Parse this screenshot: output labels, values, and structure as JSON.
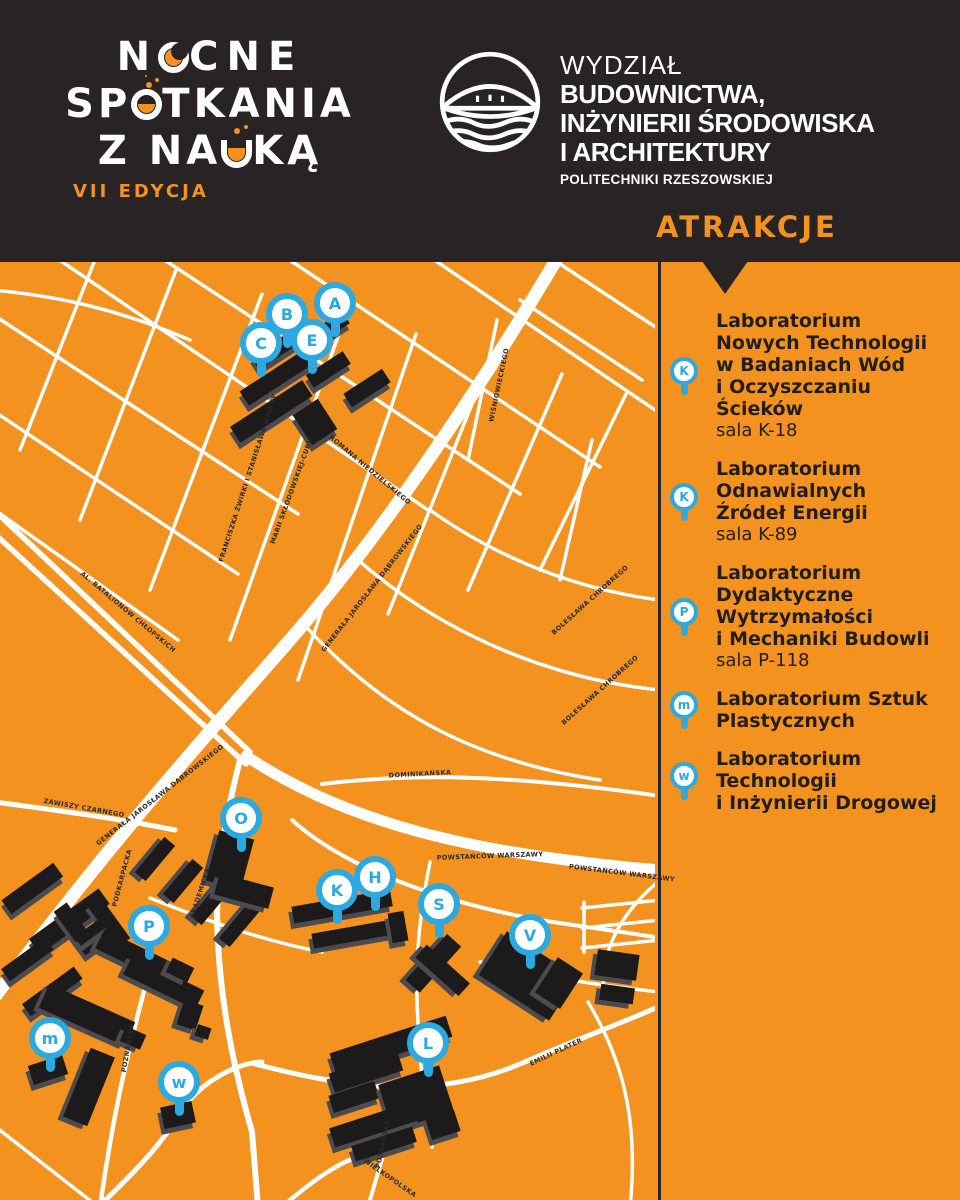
{
  "colors": {
    "orange": "#F3921E",
    "dark": "#282325",
    "pin_blue": "#2BA9E0",
    "building": "#1D1A1B",
    "road": "#FFFFFF"
  },
  "logo": {
    "word1_start": "N",
    "word1_end": "CNE",
    "word2_start": "SP",
    "word2_end": "TKANIA",
    "word3_start": "Z NA",
    "word3_end": "KĄ",
    "edition": "VII EDYCJA"
  },
  "faculty": {
    "line1": "WYDZIAŁ",
    "line2": "BUDOWNICTWA,",
    "line3": "INŻYNIERII ŚRODOWISKA",
    "line4": "I ARCHITEKTURY",
    "line5": "POLITECHNIKI RZESZOWSKIEJ"
  },
  "attractions": {
    "title": "ATRAKCJE",
    "items": [
      {
        "pin": "K",
        "title": "Laboratorium\nNowych Technologii\nw Badaniach Wód\ni Oczyszczaniu\nŚcieków",
        "room": "sala K-18"
      },
      {
        "pin": "K",
        "title": "Laboratorium\nOdnawialnych\nŹródeł Energii",
        "room": "sala K-89"
      },
      {
        "pin": "P",
        "title": "Laboratorium\nDydaktyczne\nWytrzymałości\ni Mechaniki Budowli",
        "room": "sala P-118"
      },
      {
        "pin": "m",
        "title": "Laboratorium Sztuk\nPlastycznych",
        "room": ""
      },
      {
        "pin": "w",
        "title": "Laboratorium\nTechnologii\ni Inżynierii Drogowej",
        "room": ""
      }
    ]
  },
  "map": {
    "pins": [
      {
        "letter": "A",
        "x": 335,
        "y": 303
      },
      {
        "letter": "B",
        "x": 287,
        "y": 314
      },
      {
        "letter": "C",
        "x": 261,
        "y": 343
      },
      {
        "letter": "E",
        "x": 312,
        "y": 340
      },
      {
        "letter": "O",
        "x": 241,
        "y": 818
      },
      {
        "letter": "P",
        "x": 149,
        "y": 926
      },
      {
        "letter": "K",
        "x": 337,
        "y": 890
      },
      {
        "letter": "H",
        "x": 375,
        "y": 877
      },
      {
        "letter": "S",
        "x": 439,
        "y": 904
      },
      {
        "letter": "V",
        "x": 530,
        "y": 935
      },
      {
        "letter": "m",
        "x": 50,
        "y": 1038
      },
      {
        "letter": "w",
        "x": 179,
        "y": 1082
      },
      {
        "letter": "L",
        "x": 428,
        "y": 1043
      }
    ],
    "street_labels": [
      {
        "text": "FRANCISZKA ŻWIRKI I STANISŁAWA WIGURY",
        "x": 248,
        "y": 478,
        "angle": -72
      },
      {
        "text": "MARII SKŁODOWSKIEJ-CURIE",
        "x": 292,
        "y": 490,
        "angle": -70
      },
      {
        "text": "ROMANA NIEDZIELSKIEGO",
        "x": 370,
        "y": 470,
        "angle": 40
      },
      {
        "text": "WIŚNIOWIECKIEGO",
        "x": 499,
        "y": 385,
        "angle": -78
      },
      {
        "text": "BOLESŁAWA CHROBREGO",
        "x": 590,
        "y": 600,
        "angle": -42
      },
      {
        "text": "BOLESŁAWA CHROBREGO",
        "x": 600,
        "y": 690,
        "angle": -42
      },
      {
        "text": "AL. BATALIONÓW CHŁOPSKICH",
        "x": 128,
        "y": 612,
        "angle": 40
      },
      {
        "text": "GENERAŁA JAROSŁAWA DĄBROWSKIEGO",
        "x": 372,
        "y": 588,
        "angle": -52
      },
      {
        "text": "GENERAŁA JAROSŁAWA DĄBROWSKIEGO",
        "x": 160,
        "y": 795,
        "angle": -38
      },
      {
        "text": "ZAWISZY CZARNEGO",
        "x": 84,
        "y": 808,
        "angle": 10
      },
      {
        "text": "PODKARPACKA",
        "x": 122,
        "y": 878,
        "angle": -75
      },
      {
        "text": "AKADEMICKA",
        "x": 200,
        "y": 893,
        "angle": -72
      },
      {
        "text": "POWSTAŃCÓW WARSZAWY",
        "x": 490,
        "y": 856,
        "angle": -2
      },
      {
        "text": "POWSTAŃCÓW WARSZAWY",
        "x": 622,
        "y": 873,
        "angle": 7
      },
      {
        "text": "DOMINIKAŃSKA",
        "x": 420,
        "y": 774,
        "angle": -3
      },
      {
        "text": "POZNAŃSKA",
        "x": 128,
        "y": 1048,
        "angle": -80
      },
      {
        "text": "POZNAŃSKA",
        "x": 383,
        "y": 1144,
        "angle": -78
      },
      {
        "text": "WIELKOPOLSKA",
        "x": 390,
        "y": 1178,
        "angle": 35
      },
      {
        "text": "EMILII PLATER",
        "x": 556,
        "y": 1052,
        "angle": -25
      }
    ]
  }
}
